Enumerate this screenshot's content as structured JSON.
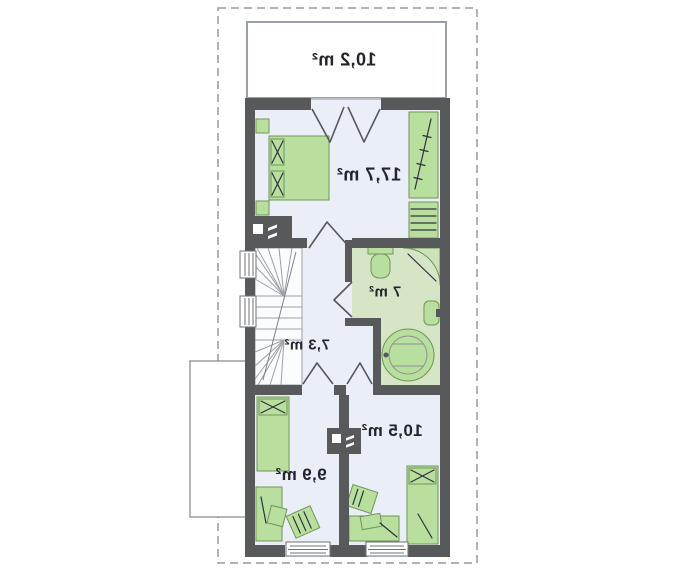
{
  "title": "Attic floor plan (mirrored)",
  "colors": {
    "wall": "#58595b",
    "floor": "#eaeef7",
    "stairs": "#fbfcfe",
    "bath_floor": "#d6e5c6",
    "furniture": "#b9df9e",
    "furniture_border": "#70945a",
    "dashed": "#9a9a9a",
    "text": "#23252e"
  },
  "rooms": [
    {
      "id": "terrace",
      "area_label": "10,2 m²"
    },
    {
      "id": "bedroom-large",
      "area_label": "17,7 m²"
    },
    {
      "id": "bathroom",
      "area_label": "7 m²"
    },
    {
      "id": "hallway",
      "area_label": "7,3 m²"
    },
    {
      "id": "bedroom-right",
      "area_label": "10,5 m²"
    },
    {
      "id": "bedroom-left",
      "area_label": "9,9 m²"
    }
  ]
}
